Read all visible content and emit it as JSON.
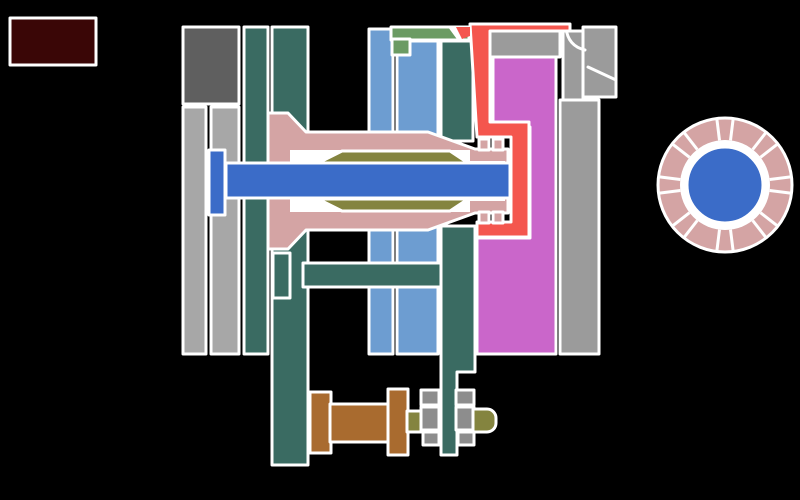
{
  "diagram": {
    "description_visible_text": "",
    "legend_swatch": {
      "present": true
    }
  },
  "colors": {
    "background": "#000000",
    "outline": "#ffffff",
    "legend_box": "#3a0606",
    "dark_gray": "#5f5f5f",
    "light_gray": "#a7a7a7",
    "mid_gray": "#9b9b9b",
    "hatch_gray": "#8d8d8d",
    "teal": "#3a6b62",
    "light_blue": "#6d9dd1",
    "green": "#6b9b63",
    "magenta": "#ca66ca",
    "red": "#f4564e",
    "pink": "#d4a4a4",
    "olive": "#84843f",
    "blue": "#3b6cc8",
    "brown": "#a96b2f"
  },
  "ring": {
    "center_x": 725,
    "center_y": 185,
    "outer_radius": 67,
    "inner_radius": 45,
    "bore_radius": 38,
    "divider_pairs": 8,
    "divider_half_angle_deg": 7
  }
}
